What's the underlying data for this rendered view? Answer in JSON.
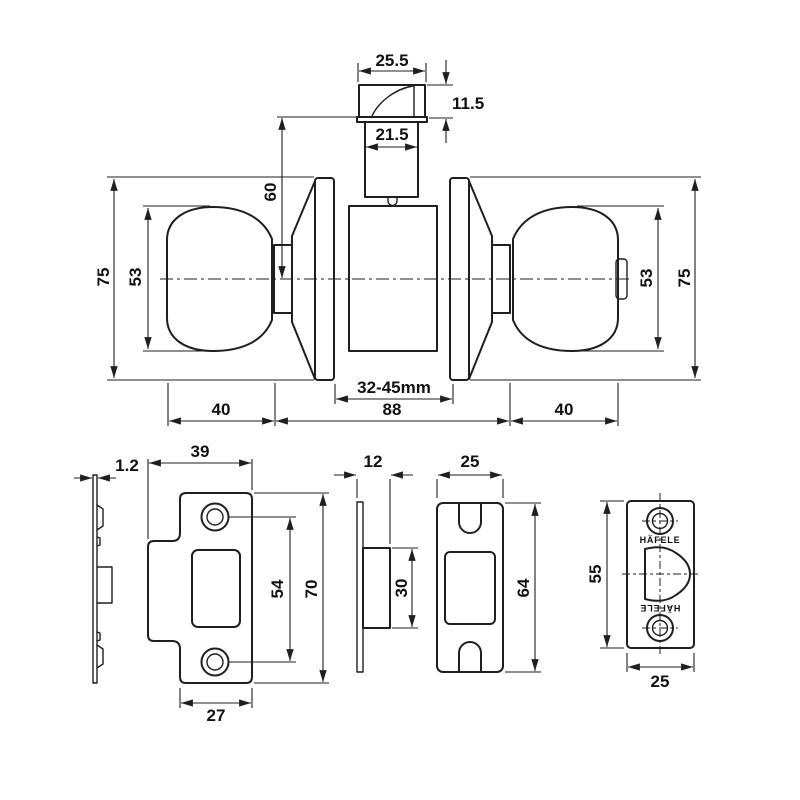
{
  "colors": {
    "background": "#ffffff",
    "line": "#1f1f1f"
  },
  "knobset": {
    "bolt_width": "25.5",
    "bolt_height": "11.5",
    "stem_width": "21.5",
    "backset": "60",
    "left_overall_dia": "75",
    "left_knob_dia": "53",
    "right_knob_dia": "53",
    "right_overall_dia": "75",
    "door_thickness_range": "32-45mm",
    "left_projection": "40",
    "chassis_length": "88",
    "right_projection": "40"
  },
  "strike_plate": {
    "thickness": "1.2",
    "width": "39",
    "hole_spacing": "54",
    "height": "70",
    "lip_width": "27"
  },
  "latch_case": {
    "depth": "12",
    "case_height": "30"
  },
  "faceplate": {
    "width": "25",
    "height": "64"
  },
  "drive_in_plate": {
    "height": "55",
    "width": "25",
    "brand_top": "HÄFELE",
    "brand_bottom": "HÄFELE"
  }
}
